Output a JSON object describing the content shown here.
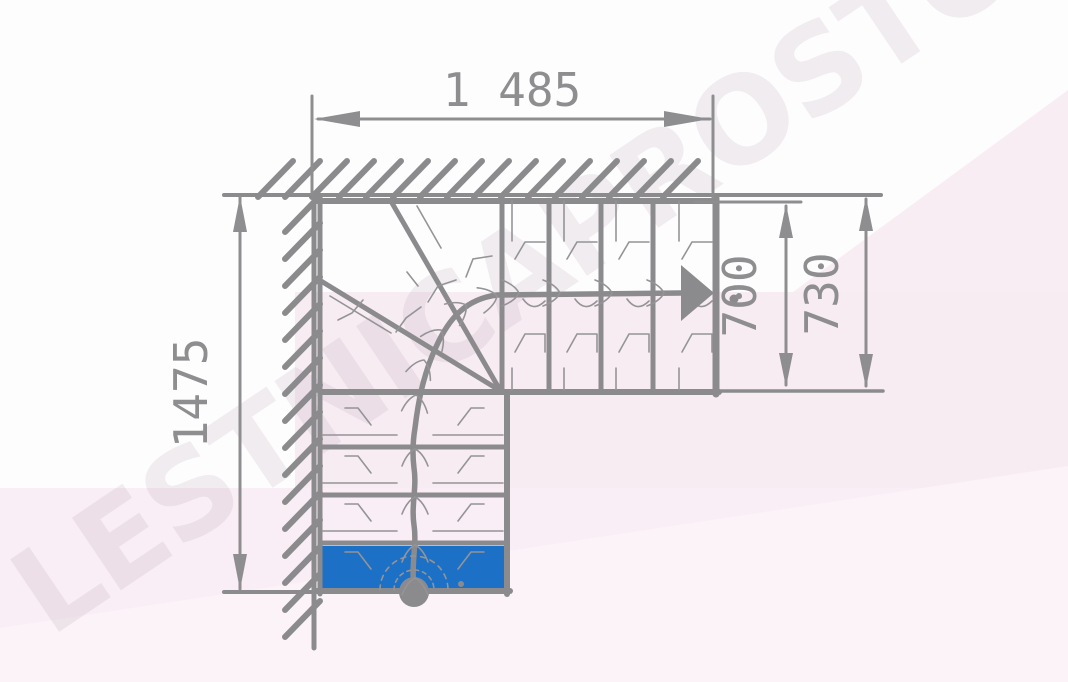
{
  "watermark": {
    "text": "LESTNICAPROSTO.RU"
  },
  "dimensions": {
    "top_width": "1 485",
    "left_height": "1475",
    "flight_width_inner": "700",
    "flight_width_outer": "730"
  },
  "colors": {
    "line_gray": "#8b8b8d",
    "dim_text": "#8e8e90",
    "highlight_step": "#1c70c5",
    "pink_band": "#f8ecf3",
    "pink_top_right": "#f9edf4",
    "pink_bottom": "#f9eef5",
    "pink_light_wedge": "#fbf3f8",
    "watermark": "#ab93a2"
  }
}
